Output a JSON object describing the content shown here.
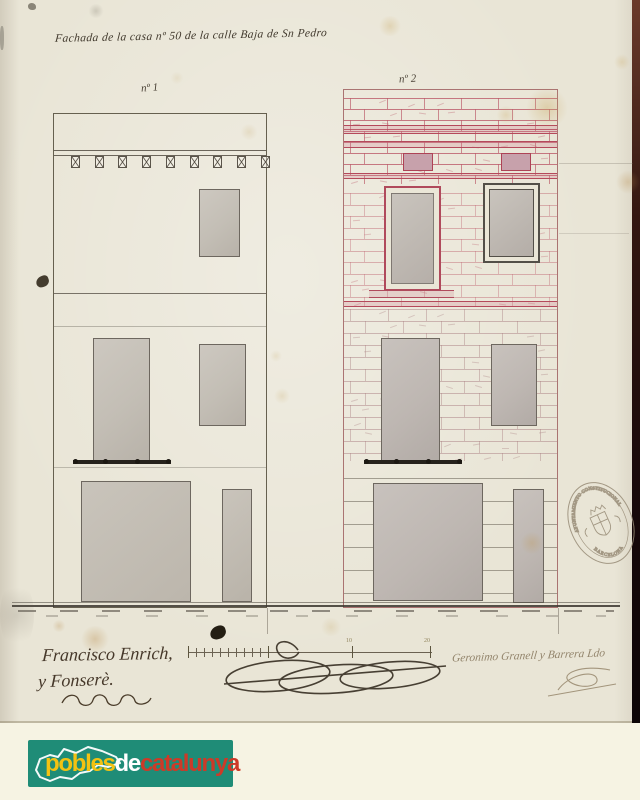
{
  "titles": {
    "main": "Fachada de la casa nº 50 de la calle Baja de Sn Pedro",
    "facade_left_label": "nº 1",
    "facade_right_label": "nº 2"
  },
  "scale_bar": {
    "labels": [
      "10",
      "20"
    ]
  },
  "signatures": {
    "left_line1": "Francisco Enrich,",
    "left_line2": "y Fonserè.",
    "right": "Geronimo Granell y Barrera Ldo"
  },
  "stamp": {
    "top_text": "AYUNTAMIENTO CONSTITUCIONAL",
    "bottom_text": "BARCELONA"
  },
  "watermark_logo": {
    "word1": "pobles",
    "word2": "de",
    "word3": "catalunya",
    "background_color": "#1f8c77",
    "word1_color": "#f3c212",
    "word2_color": "#ffffff",
    "word3_color": "#cd3a28"
  },
  "drawing_colors": {
    "dark_ink": "#5f594e",
    "red_ink": "#b5495b",
    "gray_wash": "#c3beb5",
    "paper": "#e9e5d6"
  }
}
